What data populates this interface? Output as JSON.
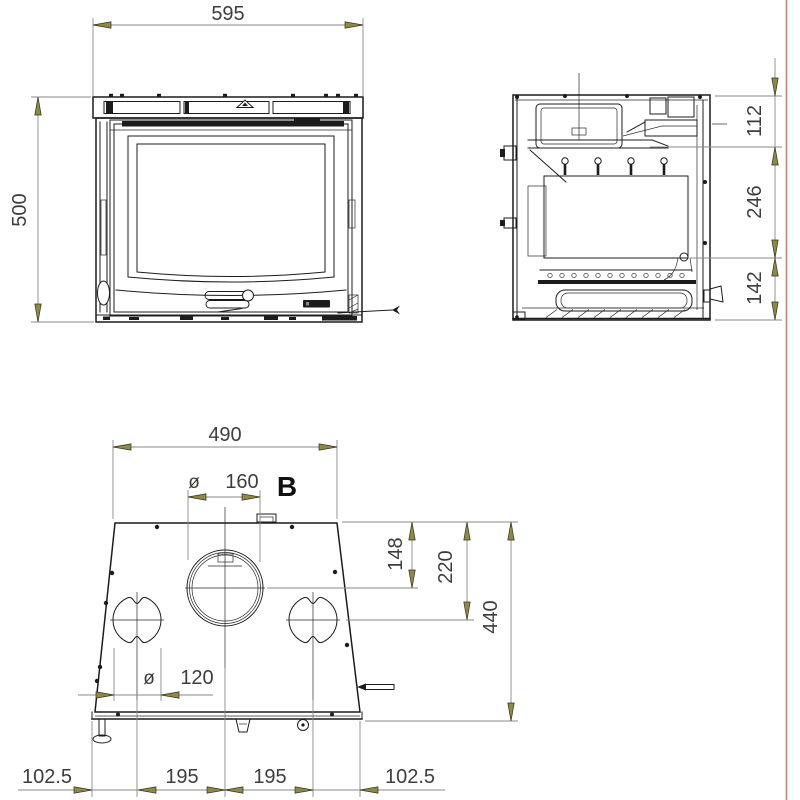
{
  "drawing": {
    "title": "stove-insert-dimension-drawing",
    "views": {
      "front": {
        "width_mm": "595",
        "height_mm": "500"
      },
      "side": {
        "top_section_mm": "112",
        "middle_section_mm": "246",
        "bottom_section_mm": "142"
      },
      "top": {
        "view_label": "B",
        "width_mm": "490",
        "flue_diameter_symbol": "ø",
        "flue_diameter_mm": "160",
        "flue_center_from_back_mm": "148",
        "side_outlet_center_from_back_mm": "220",
        "depth_mm": "440",
        "side_outlet_diameter_symbol": "ø",
        "side_outlet_diameter_mm": "120",
        "base_left_margin_mm": "102.5",
        "base_left_spacing_mm": "195",
        "base_right_spacing_mm": "195",
        "base_right_margin_mm": "102.5"
      }
    },
    "style": {
      "object_line_color": "#1c1c1c",
      "dimension_line_color": "#8a8a8a",
      "arrow_fill_color": "#8e8948",
      "text_color": "#3d3d3d",
      "page_edge_line_color": "#c97e7b",
      "background_color": "#ffffff"
    }
  }
}
